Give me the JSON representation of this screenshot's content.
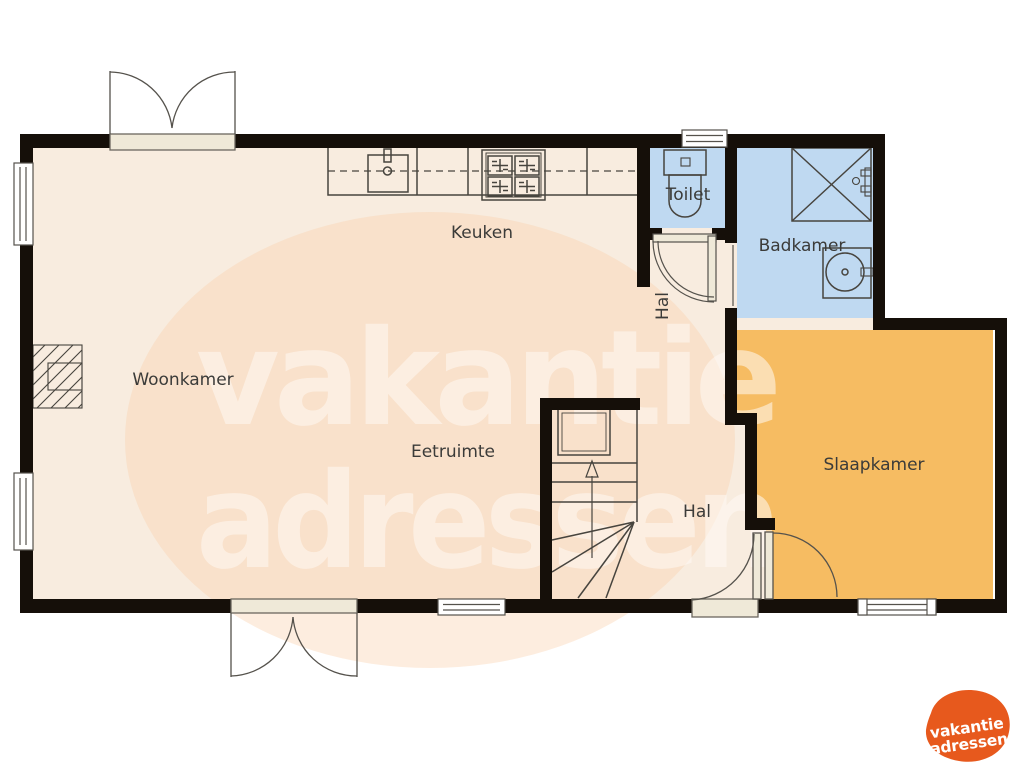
{
  "plan": {
    "rooms": [
      {
        "id": "woonkamer",
        "label": "Woonkamer"
      },
      {
        "id": "keuken",
        "label": "Keuken"
      },
      {
        "id": "eetruimte",
        "label": "Eetruimte"
      },
      {
        "id": "hal-boven",
        "label": "Hal"
      },
      {
        "id": "hal-beneden",
        "label": "Hal"
      },
      {
        "id": "toilet",
        "label": "Toilet"
      },
      {
        "id": "badkamer",
        "label": "Badkamer"
      },
      {
        "id": "slaapkamer",
        "label": "Slaapkamer"
      }
    ]
  },
  "watermark": {
    "line1": "vakantie",
    "line2": "adressen"
  },
  "logo": {
    "line1": "vakantie",
    "line2": "adressen"
  },
  "colors": {
    "floor": "#f8ecdf",
    "wet_room": "#bfd9f1",
    "bedroom": "#f6bc62",
    "wall": "#150f09",
    "fixture_line": "#47443e",
    "sill": "#efe9d8",
    "label_text": "#3b3b39",
    "watermark_blob": "#f9cfab",
    "watermark_text": "#fffaf4",
    "logo_orange": "#e7591d",
    "logo_text": "#ffffff"
  }
}
